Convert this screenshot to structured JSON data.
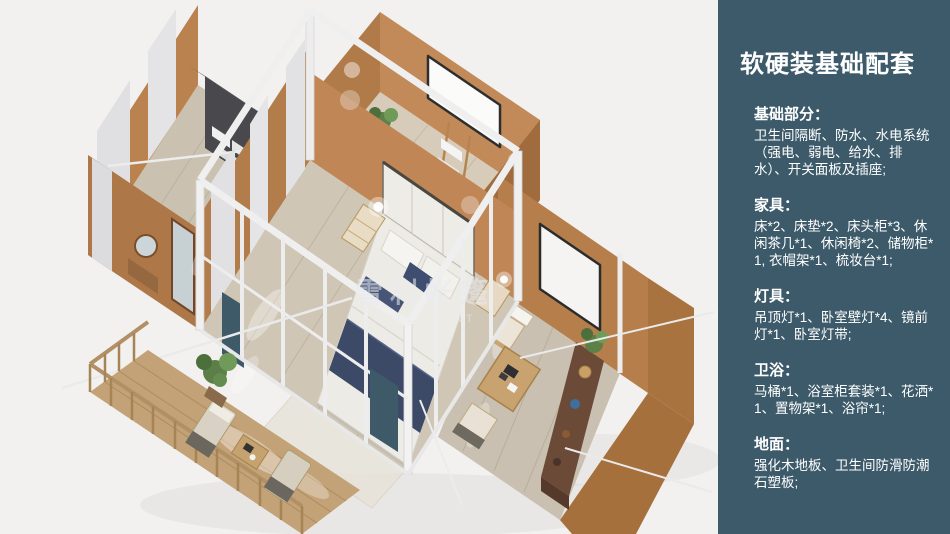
{
  "colors": {
    "panel_bg": "#3c5a69",
    "panel_text": "#ffffff",
    "canvas_bg": "#f2f1ef",
    "wall_tan": "#bb8352",
    "wall_tan_dark": "#a8713f",
    "floor_wood": "#d0c6b6",
    "deck_wood": "#c3a277",
    "frame_white": "#efefef",
    "bedding_navy": "#3c4a68",
    "teal_curtain": "#3e5a68",
    "plant_green": "#5d8049"
  },
  "watermark": {
    "cn": "雪利帐篷",
    "en": "XUELI TENT"
  },
  "panel": {
    "title": "软硬装基础配套",
    "sections": [
      {
        "title": "基础部分：",
        "body": "卫生间隔断、防水、水电系统（强电、弱电、给水、排水）、开关面板及插座;"
      },
      {
        "title": "家具：",
        "body": "床*2、床垫*2、床头柜*3、休闲茶几*1、休闲椅*2、储物柜*1, 衣帽架*1、梳妆台*1;"
      },
      {
        "title": "灯具：",
        "body": "吊顶灯*1、卧室壁灯*4、镜前灯*1、卧室灯带;"
      },
      {
        "title": "卫浴：",
        "body": "马桶*1、浴室柜套装*1、花洒*1、置物架*1、浴帘*1;"
      },
      {
        "title": "地面：",
        "body": "强化木地板、卫生间防滑防潮石塑板;"
      }
    ]
  }
}
